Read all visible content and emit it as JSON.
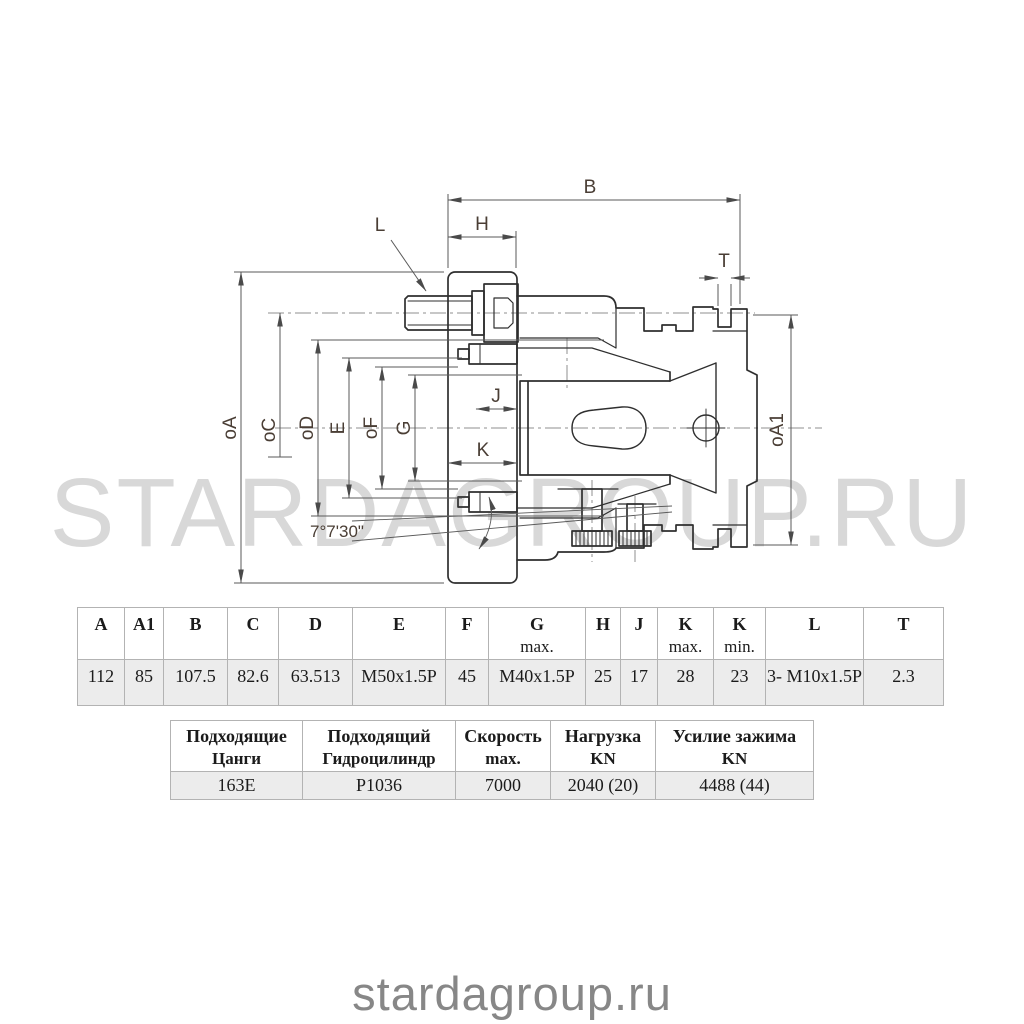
{
  "watermark": "STARDAGROUP.RU",
  "footer": "stardagroup.ru",
  "drawing": {
    "labels": {
      "b": "B",
      "h": "H",
      "l": "L",
      "t": "T",
      "j": "J",
      "k": "K",
      "oa": "oA",
      "oc": "oC",
      "od": "oD",
      "e": "E",
      "of": "oF",
      "g": "G",
      "oa1": "oA1",
      "angle": "7°7'30\""
    }
  },
  "dim_table": {
    "headers": [
      {
        "main": "A",
        "sub": ""
      },
      {
        "main": "A1",
        "sub": ""
      },
      {
        "main": "B",
        "sub": ""
      },
      {
        "main": "C",
        "sub": ""
      },
      {
        "main": "D",
        "sub": ""
      },
      {
        "main": "E",
        "sub": ""
      },
      {
        "main": "F",
        "sub": ""
      },
      {
        "main": "G",
        "sub": "max."
      },
      {
        "main": "H",
        "sub": ""
      },
      {
        "main": "J",
        "sub": ""
      },
      {
        "main": "K",
        "sub": "max."
      },
      {
        "main": "K",
        "sub": "min."
      },
      {
        "main": "L",
        "sub": ""
      },
      {
        "main": "T",
        "sub": ""
      }
    ],
    "values": [
      "112",
      "85",
      "107.5",
      "82.6",
      "63.513",
      "M50x1.5P",
      "45",
      "M40x1.5P",
      "25",
      "17",
      "28",
      "23",
      "3- M10x1.5P",
      "2.3"
    ]
  },
  "spec_table": {
    "headers": [
      {
        "line1": "Подходящие",
        "line2": "Цанги"
      },
      {
        "line1": "Подходящий",
        "line2": "Гидроцилиндр"
      },
      {
        "line1": "Скорость",
        "line2": "max."
      },
      {
        "line1": "Нагрузка",
        "line2": "KN"
      },
      {
        "line1": "Усилие зажима",
        "line2": "KN"
      }
    ],
    "values": [
      "163E",
      "P1036",
      "7000",
      "2040 (20)",
      "4488 (44)"
    ]
  }
}
